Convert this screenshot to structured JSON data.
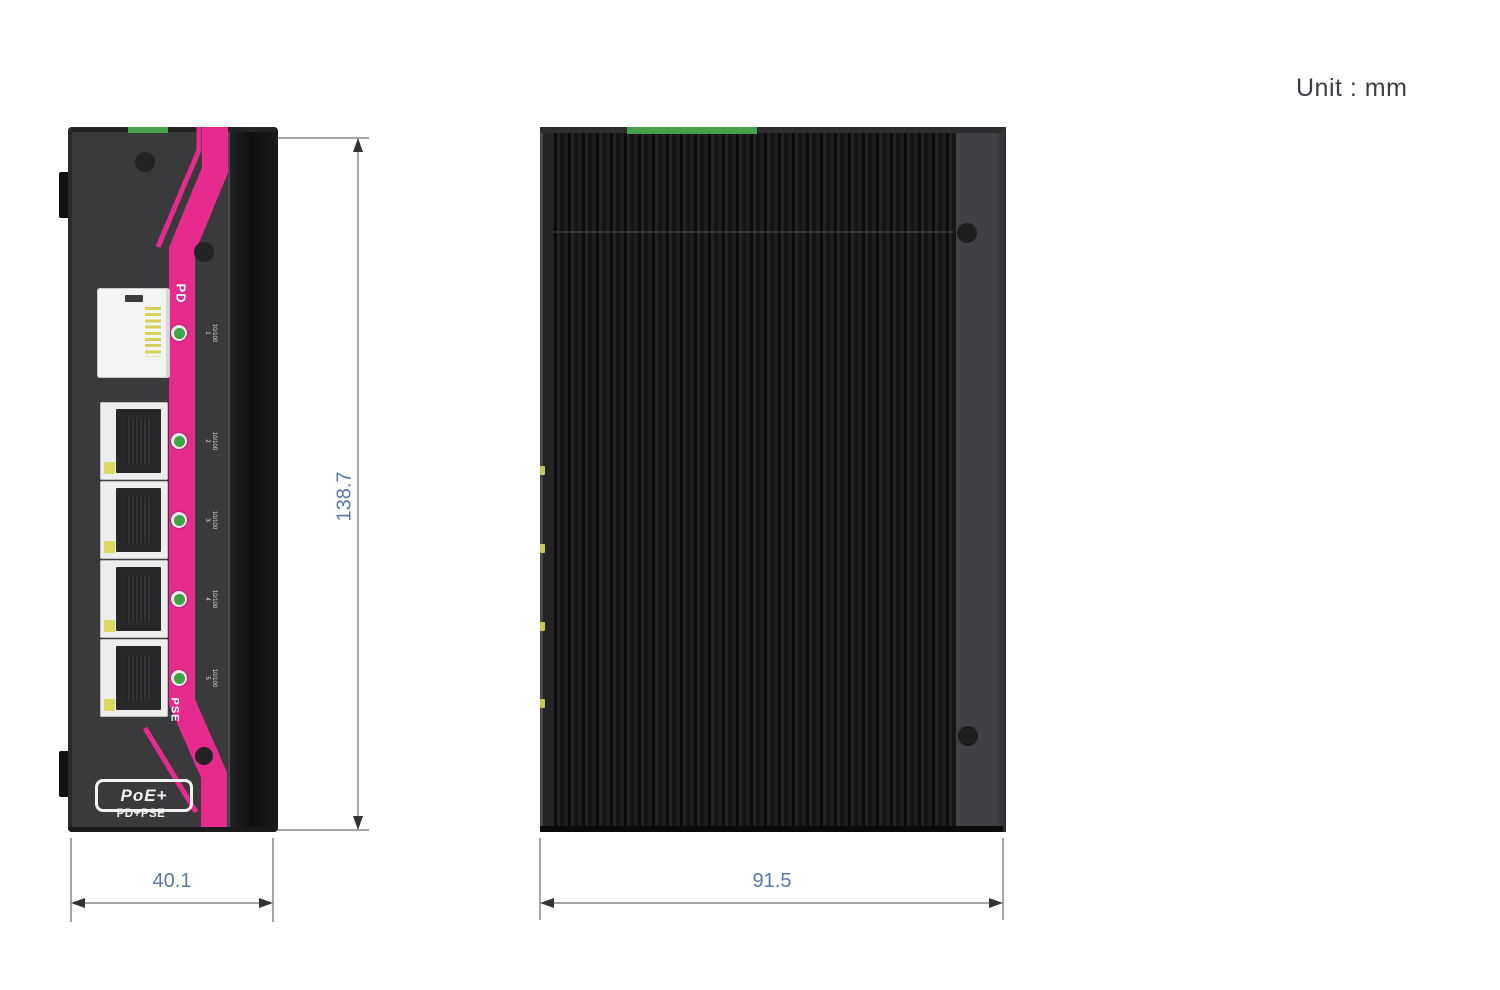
{
  "meta": {
    "unit_label": "Unit : mm"
  },
  "dimensions": {
    "height_mm": "138.7",
    "width_mm": "40.1",
    "depth_mm": "91.5"
  },
  "front_view": {
    "stripe_top_label": "PD",
    "stripe_bottom_label": "PSE",
    "logo_text": "PoE+",
    "logo_subtext": "PD+PSE",
    "port_leds": [
      {
        "speed": "10/100",
        "port": "1"
      },
      {
        "speed": "10/100",
        "port": "2"
      },
      {
        "speed": "10/100",
        "port": "3"
      },
      {
        "speed": "10/100",
        "port": "4"
      },
      {
        "speed": "10/100",
        "port": "5"
      }
    ]
  },
  "colors": {
    "accent_pink": "#e72b8e",
    "led_green": "#3fa347",
    "led_yellow": "#d9d95e",
    "terminal_green": "#47a04b",
    "dimension_text": "#587aa5"
  }
}
